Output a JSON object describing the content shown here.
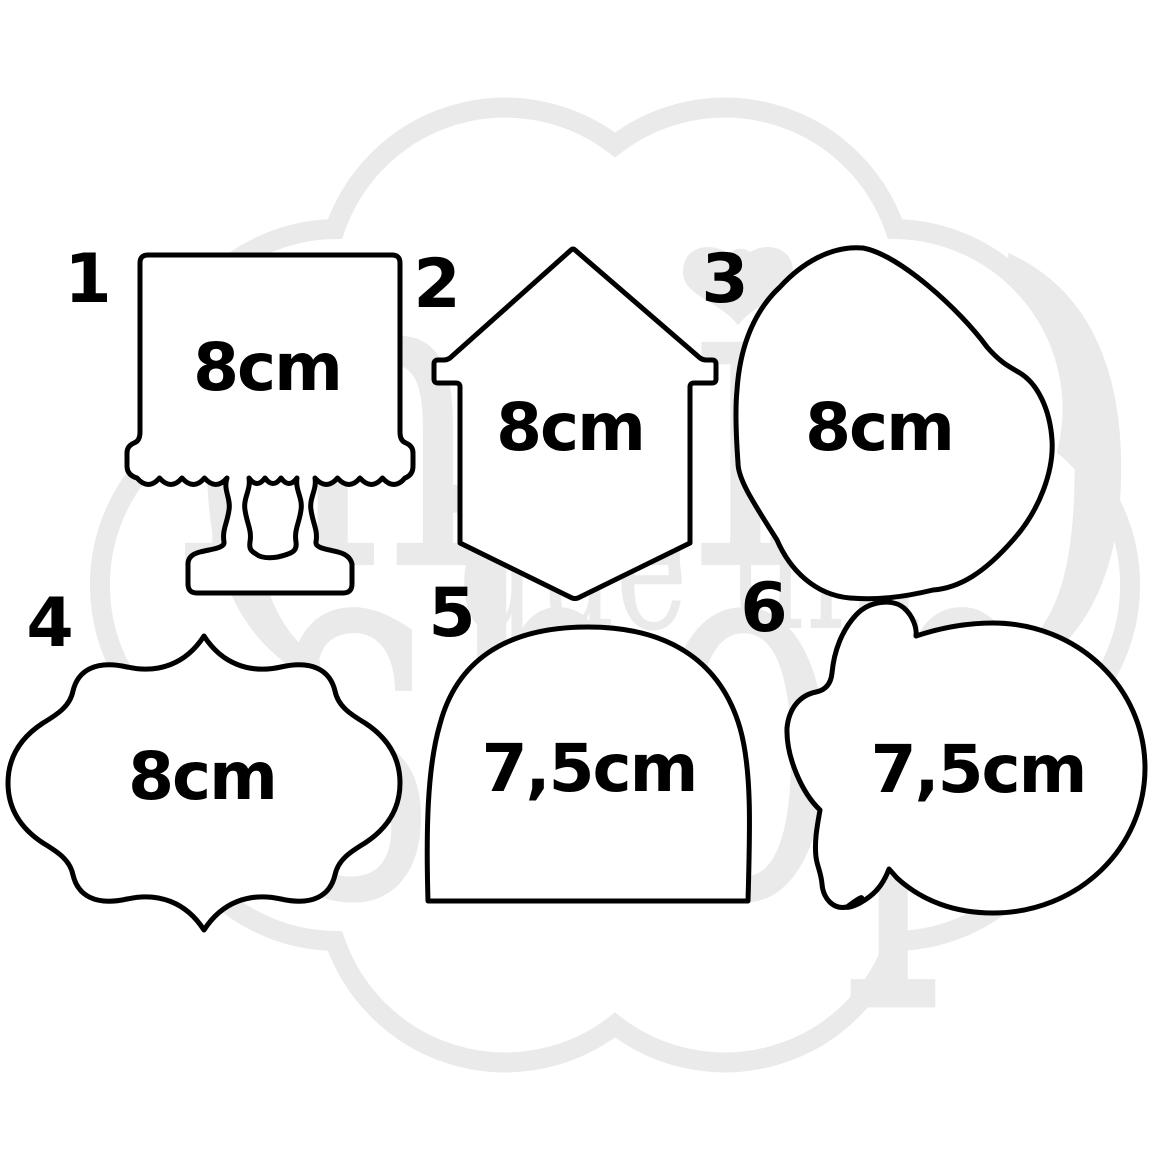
{
  "watermark": {
    "word_top": "mais",
    "word_middle": "que um",
    "word_bottom": "shop",
    "paren_open": "(",
    "paren_close": ")",
    "color": "#eaeaea"
  },
  "colors": {
    "outline": "#000000",
    "shape_fill": "#ffffff",
    "background": "#ffffff"
  },
  "shapes": [
    {
      "number": "1",
      "size_label": "8cm",
      "shape_kind": "cake-stand"
    },
    {
      "number": "2",
      "size_label": "8cm",
      "shape_kind": "banner-house"
    },
    {
      "number": "3",
      "size_label": "8cm",
      "shape_kind": "organic-blob"
    },
    {
      "number": "4",
      "size_label": "8cm",
      "shape_kind": "ornate-plaque"
    },
    {
      "number": "5",
      "size_label": "7,5cm",
      "shape_kind": "dome"
    },
    {
      "number": "6",
      "size_label": "7,5cm",
      "shape_kind": "bumpy-circle"
    }
  ]
}
